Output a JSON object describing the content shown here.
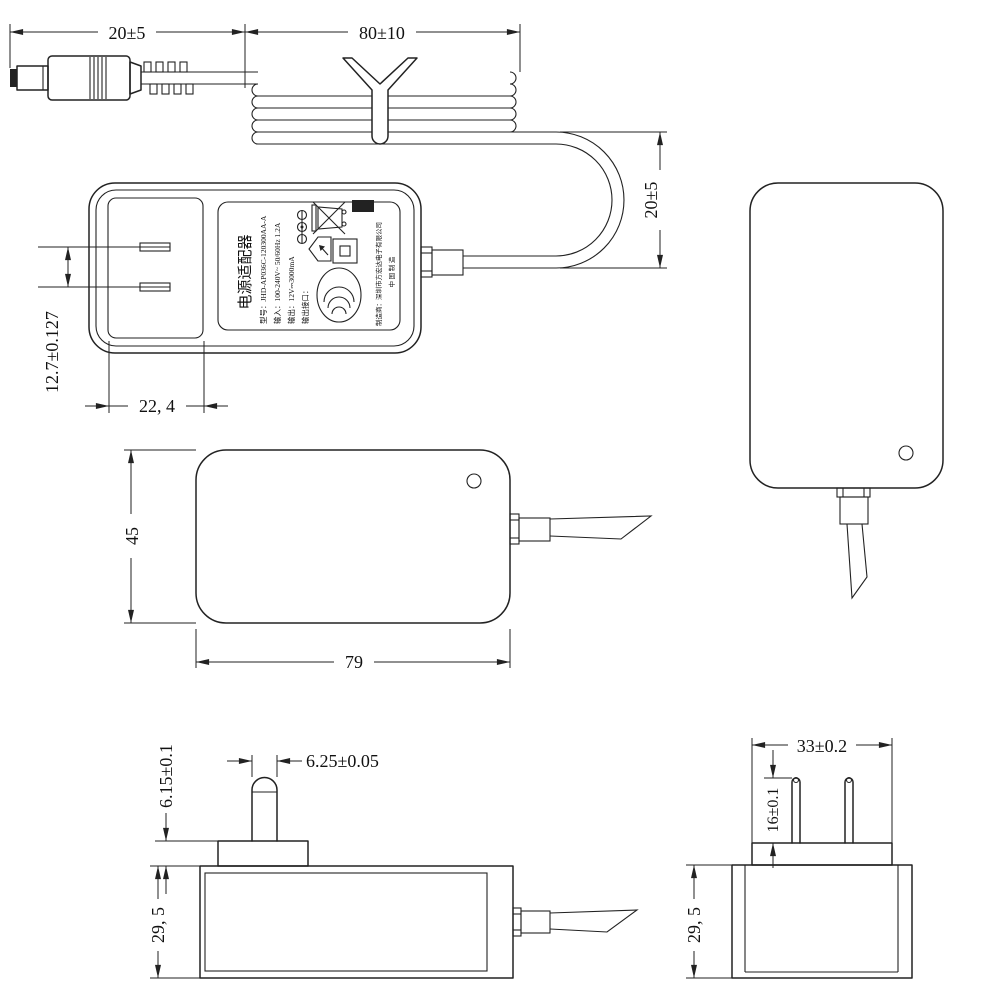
{
  "drawing": {
    "background": "#ffffff",
    "line_color": "#222222",
    "dims": {
      "plug_length": "20±5",
      "coil_length": "80±10",
      "loop_height": "20±5",
      "prong_pitch": "12.7±0.127",
      "plug_base_width": "22, 4",
      "front_height": "45",
      "front_width": "79",
      "blade_width": "6.25±0.05",
      "base_height": "6.15±0.1",
      "side_thickness": "29, 5",
      "end_thickness": "29, 5",
      "platform_width": "33±0.2",
      "blade_length": "16±0.1"
    },
    "label": {
      "title": "电源适配器",
      "model": "型号：JHD-AP036C-120300AA-A",
      "input": "输入：100-240V~ 50/60Hz 1.2A",
      "output": "输出：12V⎓3000mA",
      "output_port": "输出接口：",
      "manufacturer": "制造商：深圳市方宏达电子有限公司",
      "made_in": "中 国 制 造",
      "icons": [
        "weee-crossed-bin-icon",
        "weee-black-bar",
        "indoor-use-house-icon",
        "class-ii-double-square-icon",
        "ccc-certification-icon",
        "polarity-center-positive-icon"
      ]
    }
  }
}
